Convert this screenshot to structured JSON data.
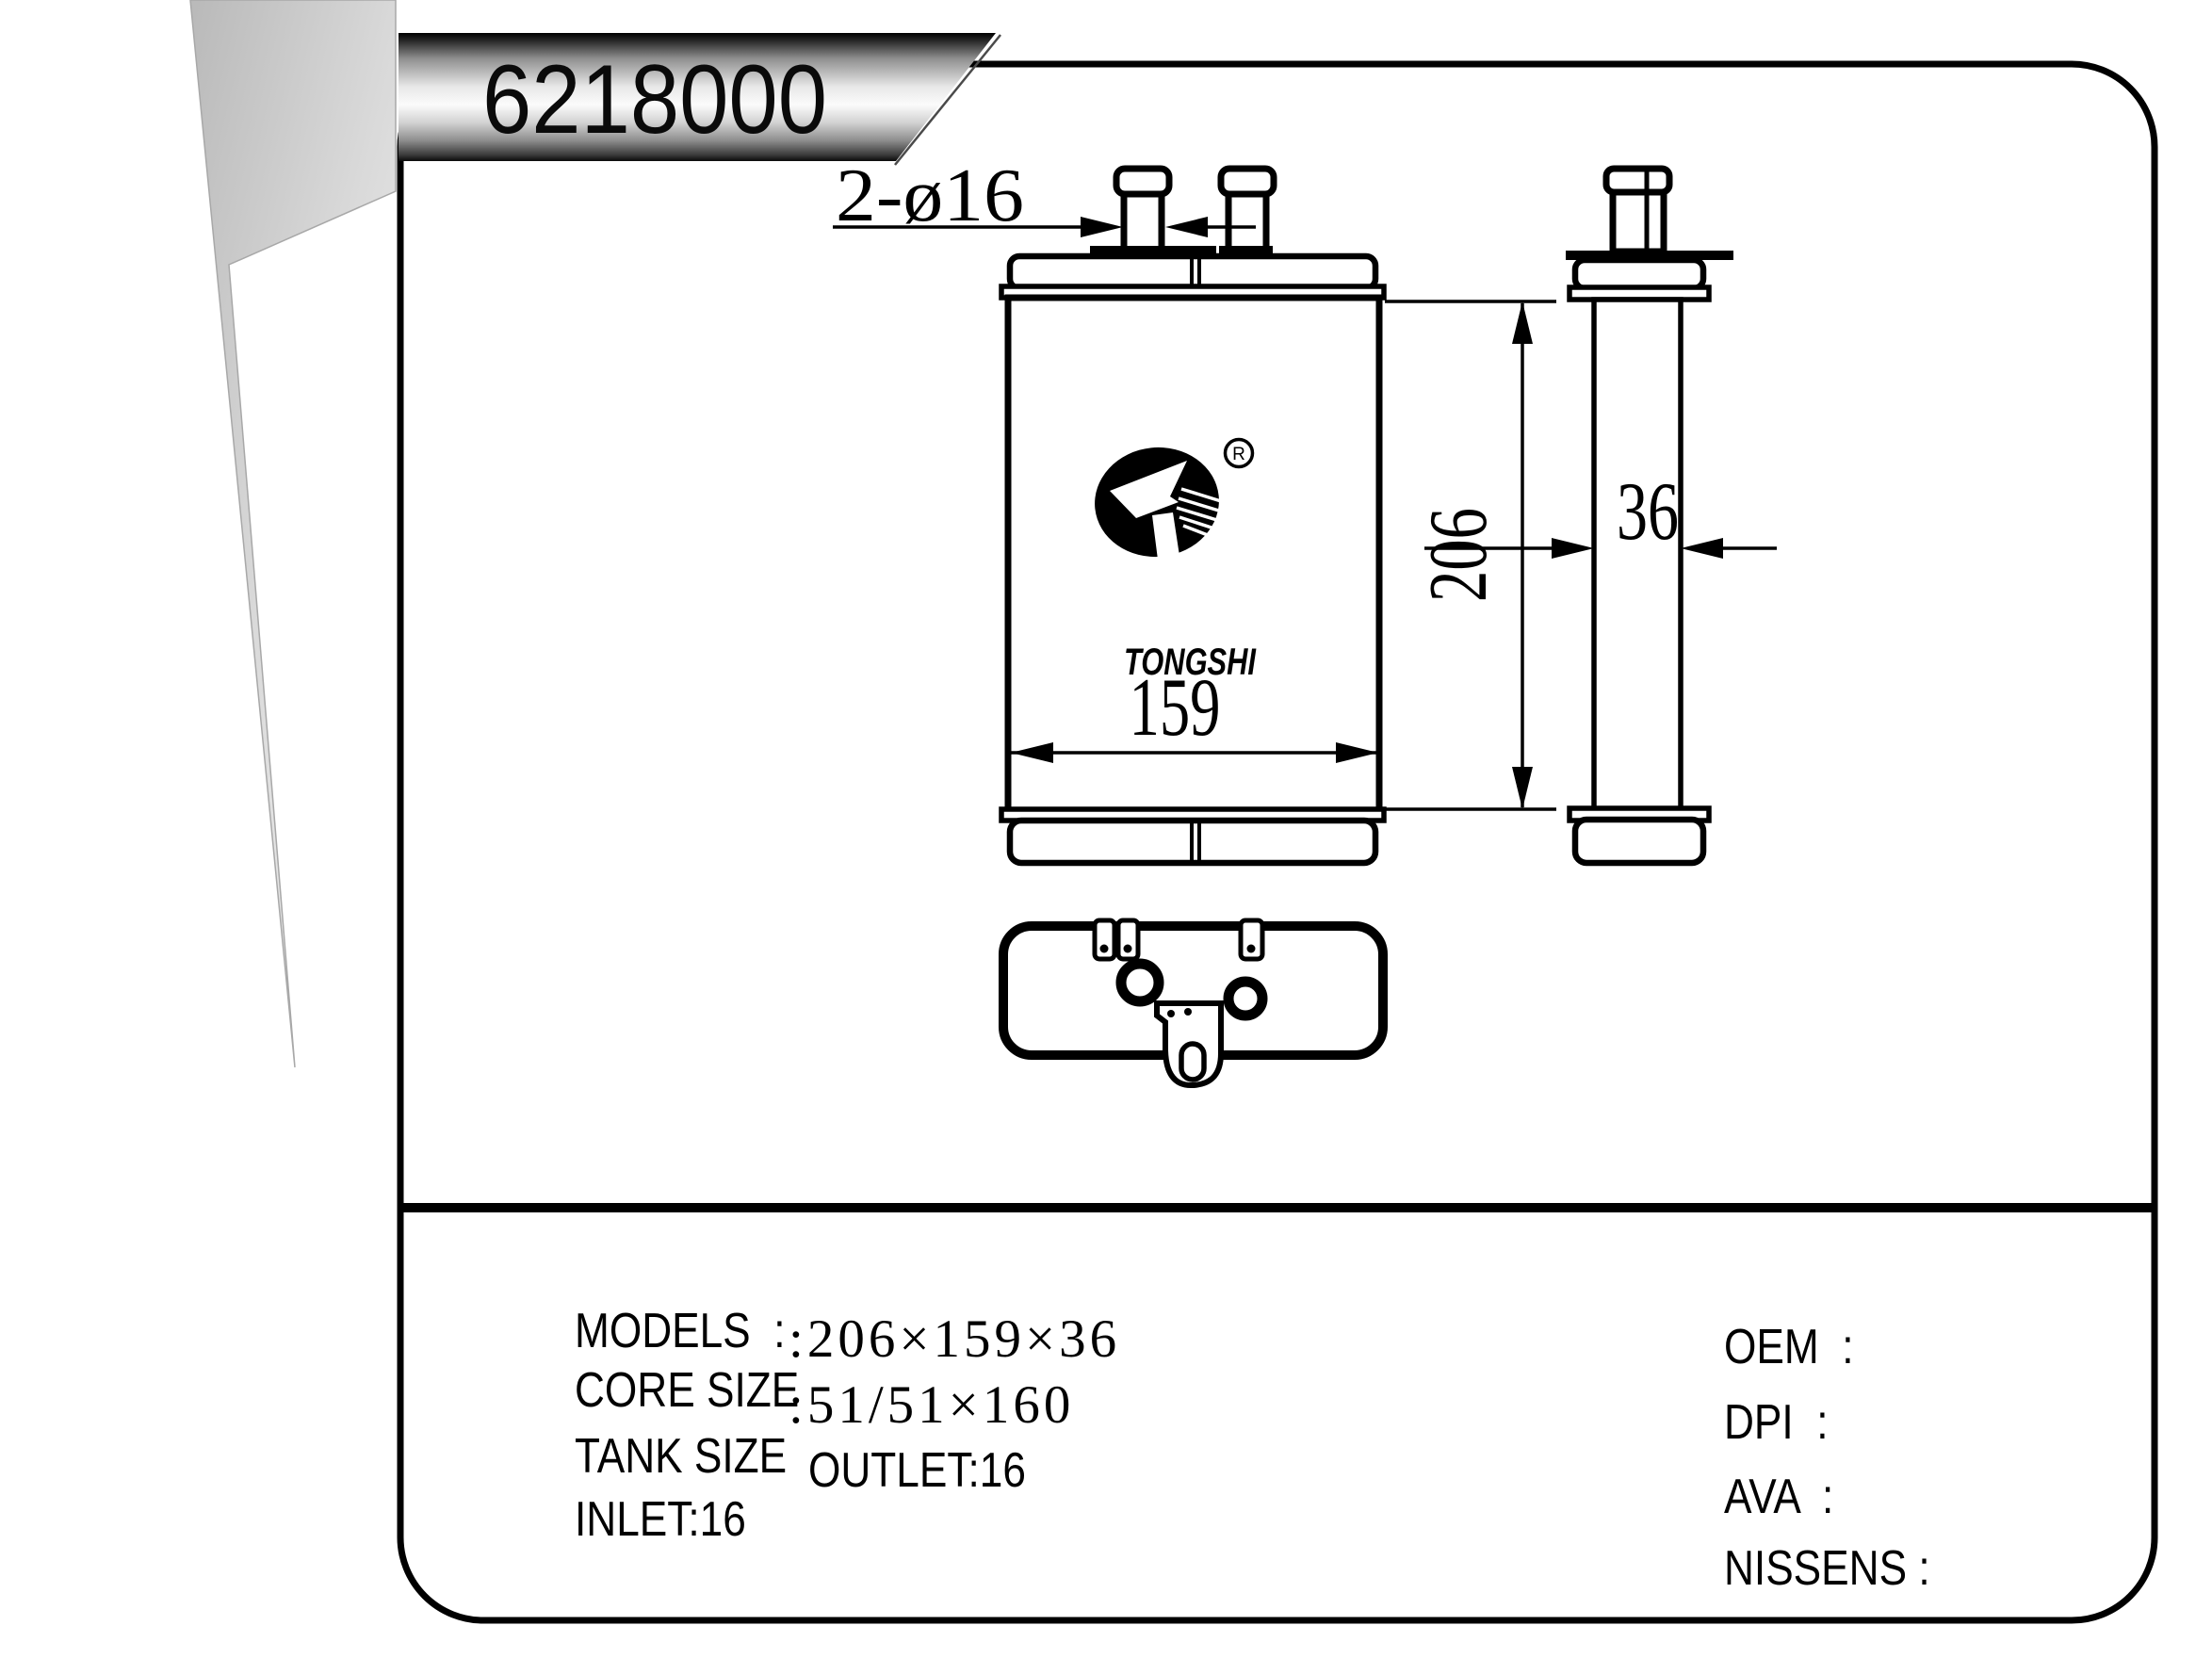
{
  "title": {
    "part_number": "6218000"
  },
  "dimensions": {
    "pipe_diameter": "2-ø16",
    "core_width": "159",
    "core_height": "206",
    "core_depth": "36"
  },
  "logo": {
    "brand": "TONGSHI",
    "registered_mark": "R"
  },
  "specs": {
    "models_label": "MODELS  :",
    "core_size_label": "CORE SIZE",
    "core_size_value": ":206×159×36",
    "tank_size_label": "TANK SIZE",
    "tank_size_value": ":51/51×160",
    "inlet_value": "INLET:16",
    "outlet_value": "OUTLET:16",
    "oem_label": "OEM  :",
    "dpi_label": "DPI  :",
    "ava_label": "AVA  :",
    "nissens_label": "NISSENS :"
  }
}
